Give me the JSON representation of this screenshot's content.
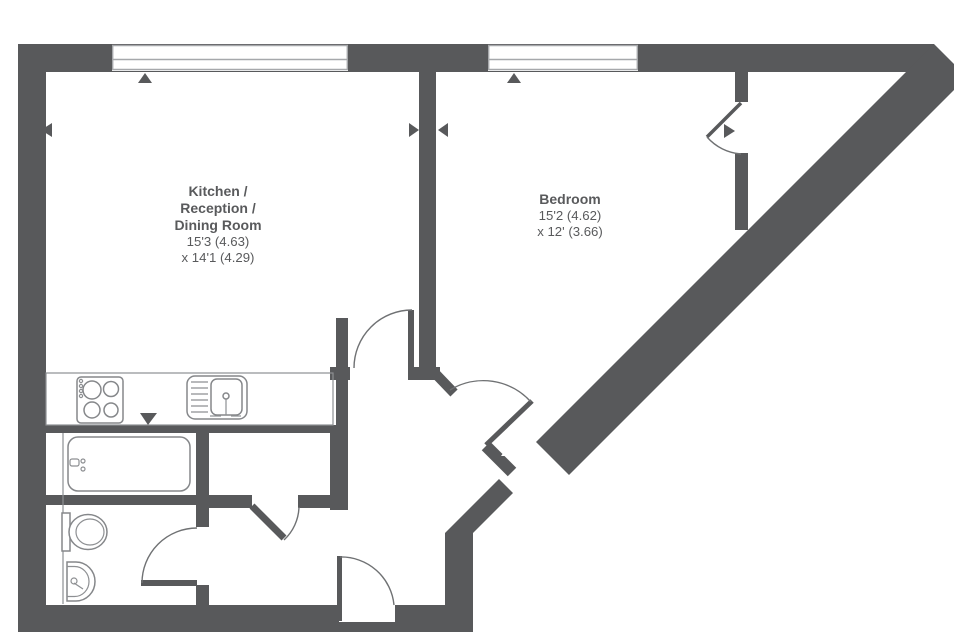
{
  "floorplan": {
    "background_color": "#ffffff",
    "wall_color": "#58595b",
    "fixture_line_color": "#85878a",
    "rooms": [
      {
        "id": "kitchen-reception-dining",
        "name_lines": [
          "Kitchen /",
          "Reception /",
          "Dining Room"
        ],
        "dimension_lines": [
          "15'3 (4.63)",
          "x 14'1 (4.29)"
        ]
      },
      {
        "id": "bedroom",
        "name_lines": [
          "Bedroom"
        ],
        "dimension_lines": [
          "15'2 (4.62)",
          "x 12' (3.66)"
        ]
      }
    ],
    "windows": [
      "kitchen-window",
      "bedroom-window"
    ],
    "doors": [
      "kitchen-door",
      "bedroom-entry-door",
      "bedroom-closet-door",
      "storage-cupboard-door",
      "bathroom-door",
      "front-door"
    ],
    "fixtures": [
      "kitchen-counter",
      "hob",
      "sink",
      "bathtub",
      "toilet",
      "wash-basin"
    ]
  }
}
